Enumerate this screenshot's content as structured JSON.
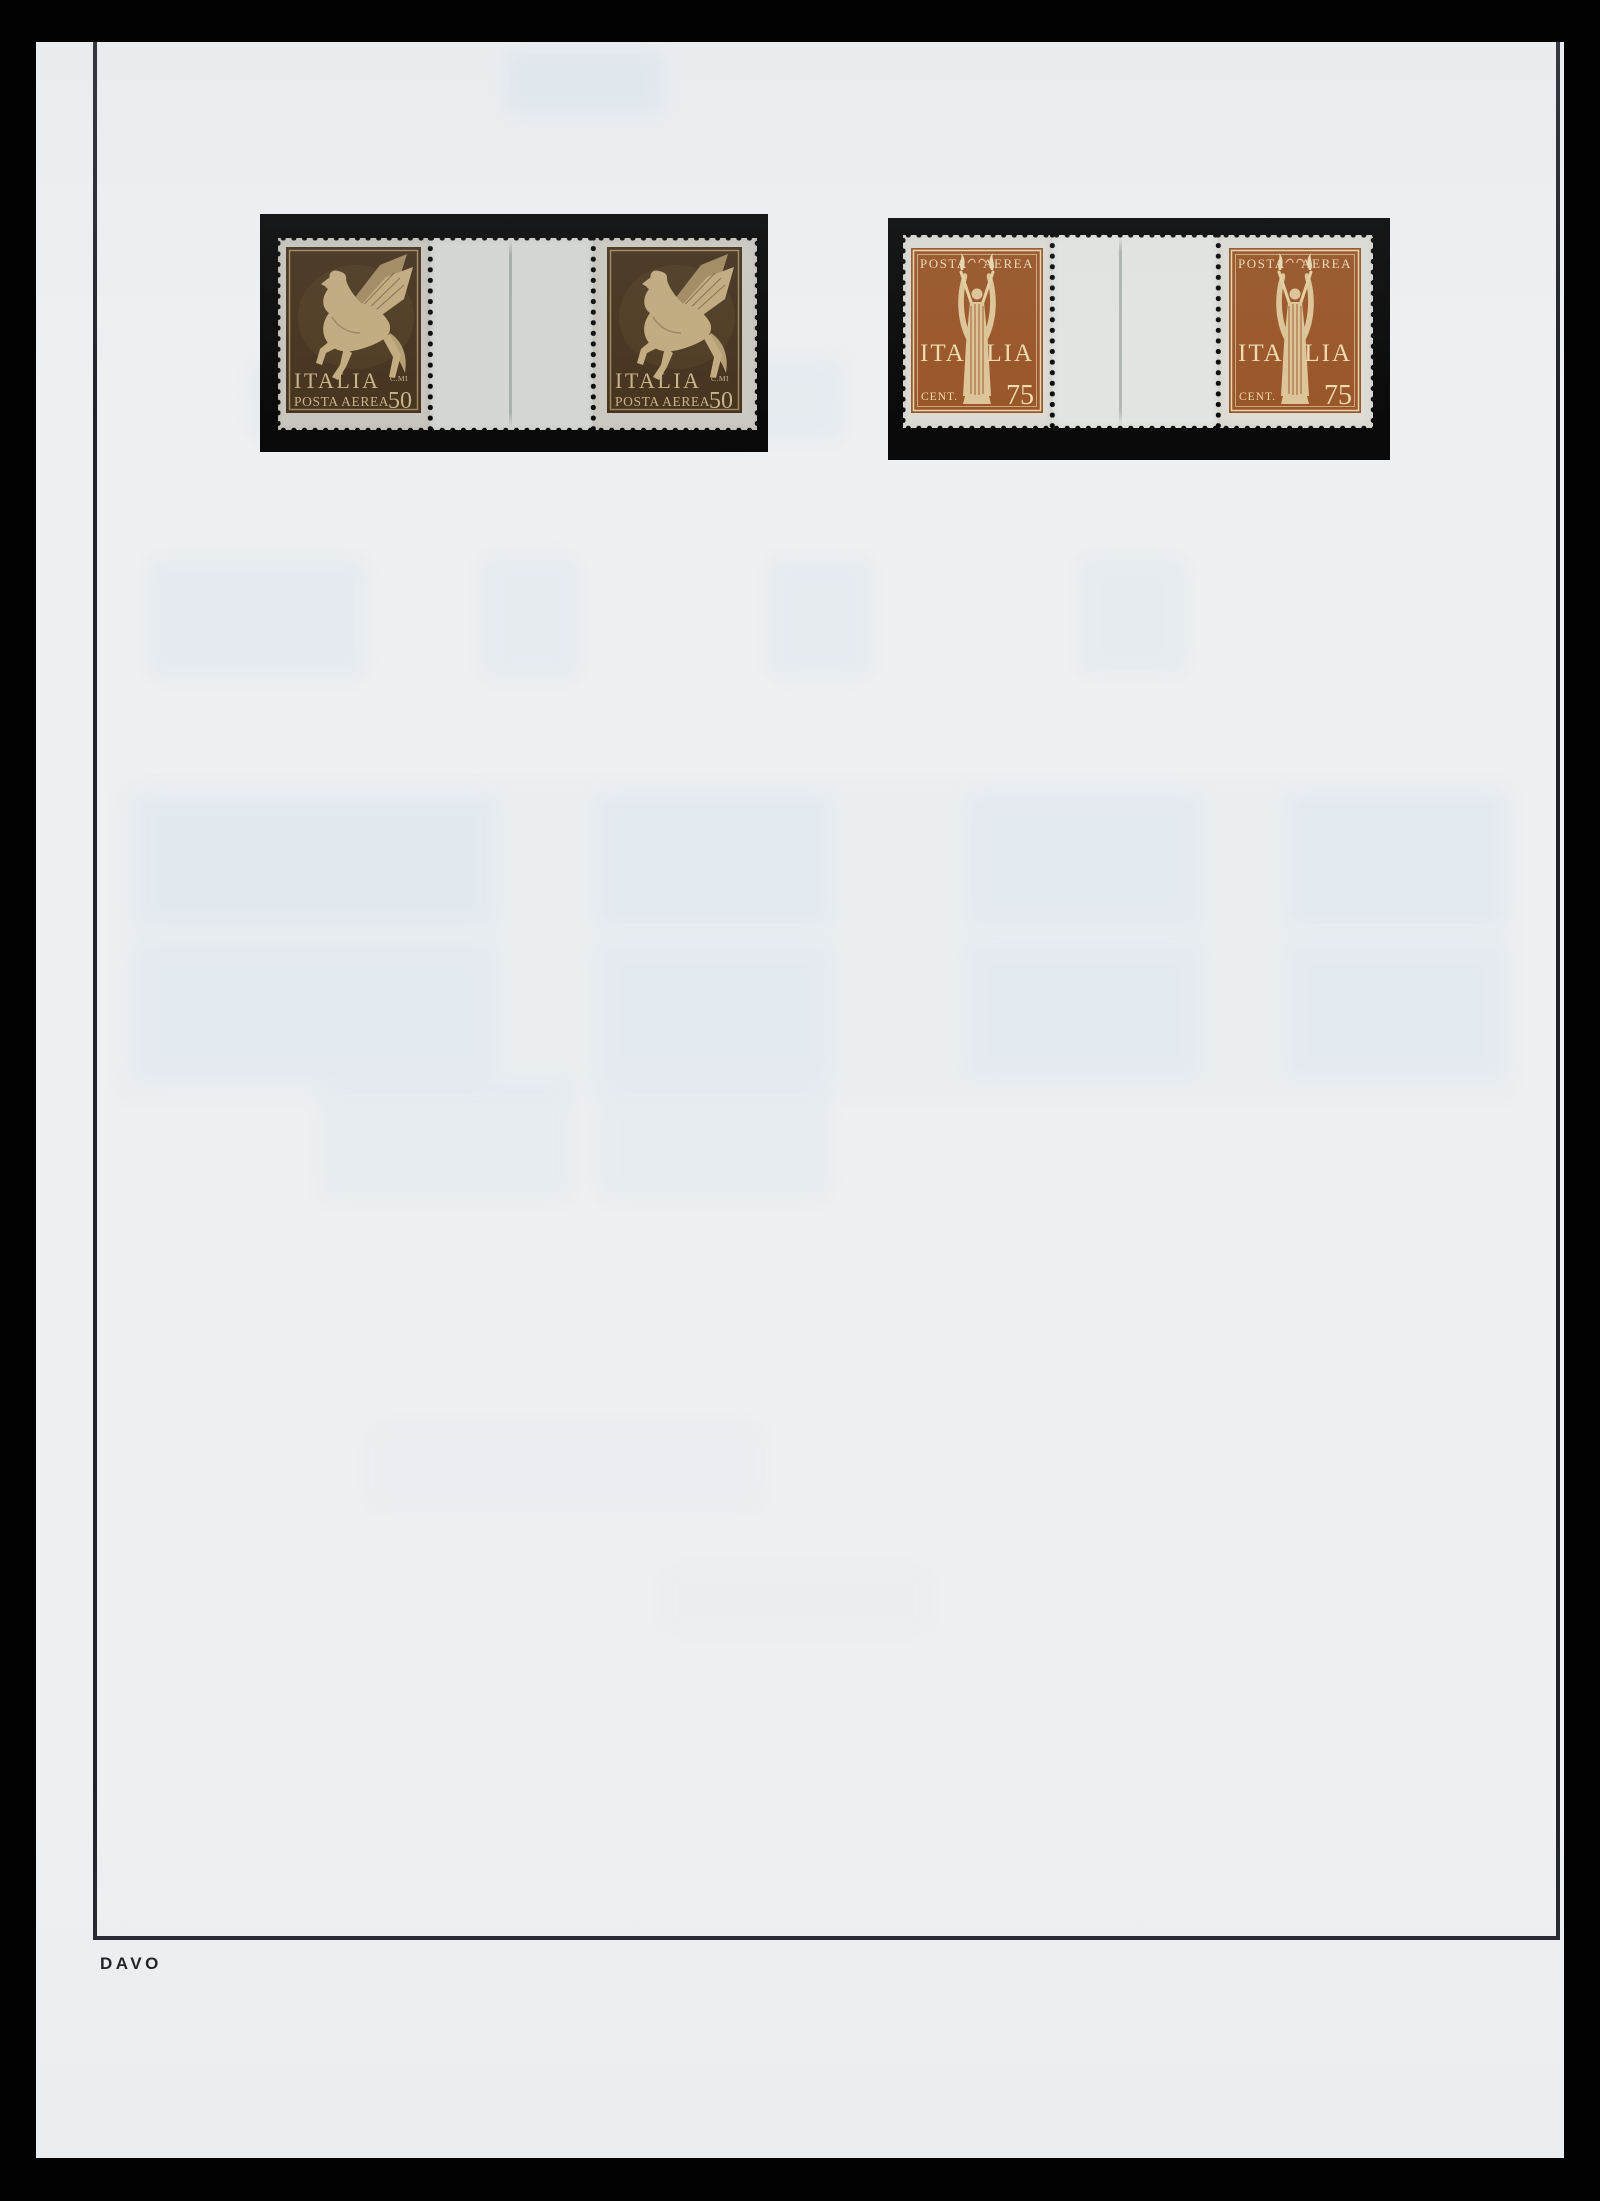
{
  "page": {
    "brand": "DAVO",
    "paper_color": "#eef0f2",
    "frame_color": "#22222a",
    "mount_color": "#0a0a0a"
  },
  "pairs": [
    {
      "type": "airmail-50c-pegasus-gutter-pair",
      "ink_color": "#46341f",
      "text": {
        "country": "ITALIA",
        "service": "POSTA AEREA",
        "value_prefix": "C.MI",
        "value": "50"
      }
    },
    {
      "type": "airmail-75c-victory-gutter-pair",
      "ink_color": "#9a5629",
      "text": {
        "service_left": "POSTA",
        "service_right": "AEREA",
        "country_left": "ITA",
        "country_right": "LIA",
        "value_prefix": "CENT.",
        "value": "75"
      }
    }
  ]
}
